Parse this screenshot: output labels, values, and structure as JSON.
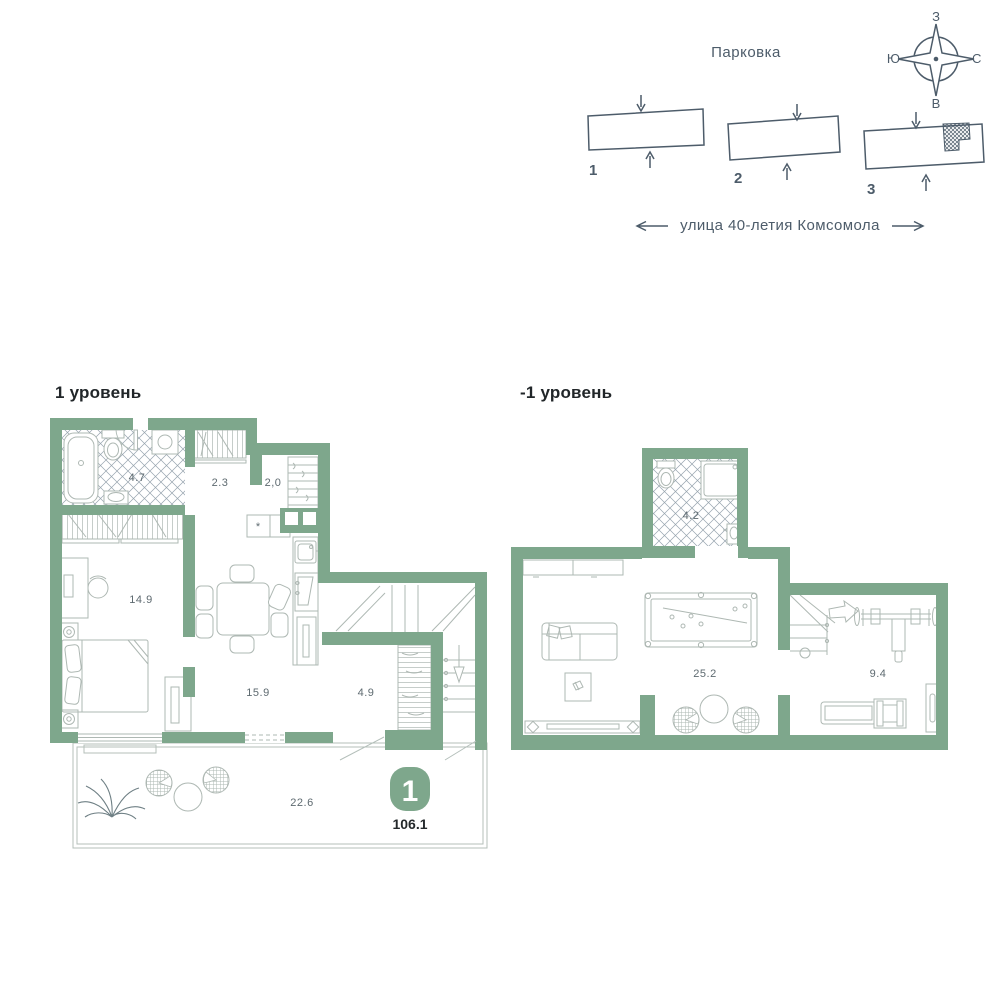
{
  "site": {
    "parking_title": "Парковка",
    "street": "улица 40-летия Комсомола",
    "buildings": [
      {
        "label": "1"
      },
      {
        "label": "2"
      },
      {
        "label": "3",
        "has_marker": true
      }
    ],
    "compass": {
      "top": "З",
      "right": "С",
      "bottom": "В",
      "left": "Ю"
    }
  },
  "level1": {
    "title": "1 уровень",
    "rooms": {
      "bathroom": "4.7",
      "hallway": "2.3",
      "closet": "2,0",
      "bedroom": "14.9",
      "kitchen_living": "15.9",
      "hall": "4.9",
      "terrace": "22.6"
    },
    "fridge_symbol": "*"
  },
  "level_minus1": {
    "title": "-1 уровень",
    "rooms": {
      "bathroom": "4.2",
      "lounge": "25.2",
      "gym": "9.4"
    }
  },
  "apartment": {
    "number": "1",
    "total_area": "106.1"
  },
  "colors": {
    "wall_green": "#7ea78c",
    "site_ink": "#4d5c6a",
    "label_gray": "#5e6a70"
  }
}
